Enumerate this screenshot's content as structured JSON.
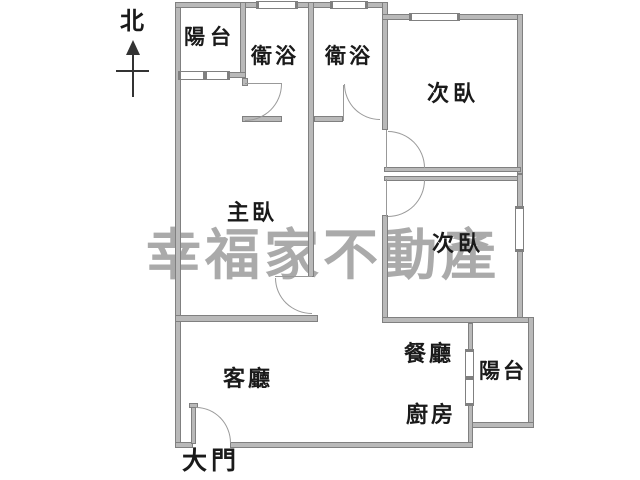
{
  "floorplan": {
    "watermark_text": "幸福家不動產",
    "compass_label": "北",
    "rooms": [
      {
        "id": "balcony-top",
        "label": "陽台"
      },
      {
        "id": "bathroom-1",
        "label": "衛浴"
      },
      {
        "id": "bathroom-2",
        "label": "衛浴"
      },
      {
        "id": "bedroom-top-right",
        "label": "次臥"
      },
      {
        "id": "master-bedroom",
        "label": "主臥"
      },
      {
        "id": "bedroom-right",
        "label": "次臥"
      },
      {
        "id": "living-room",
        "label": "客廳"
      },
      {
        "id": "dining-room",
        "label": "餐廳"
      },
      {
        "id": "kitchen",
        "label": "廚房"
      },
      {
        "id": "balcony-right",
        "label": "陽台"
      },
      {
        "id": "main-entrance",
        "label": "大門"
      }
    ],
    "colors": {
      "background": "#ffffff",
      "wall": "#b9b9b9",
      "wall_edge": "#808080",
      "line": "#999999",
      "label": "#1a1a1a",
      "watermark": "#aaaaaa",
      "compass": "#333333"
    }
  }
}
